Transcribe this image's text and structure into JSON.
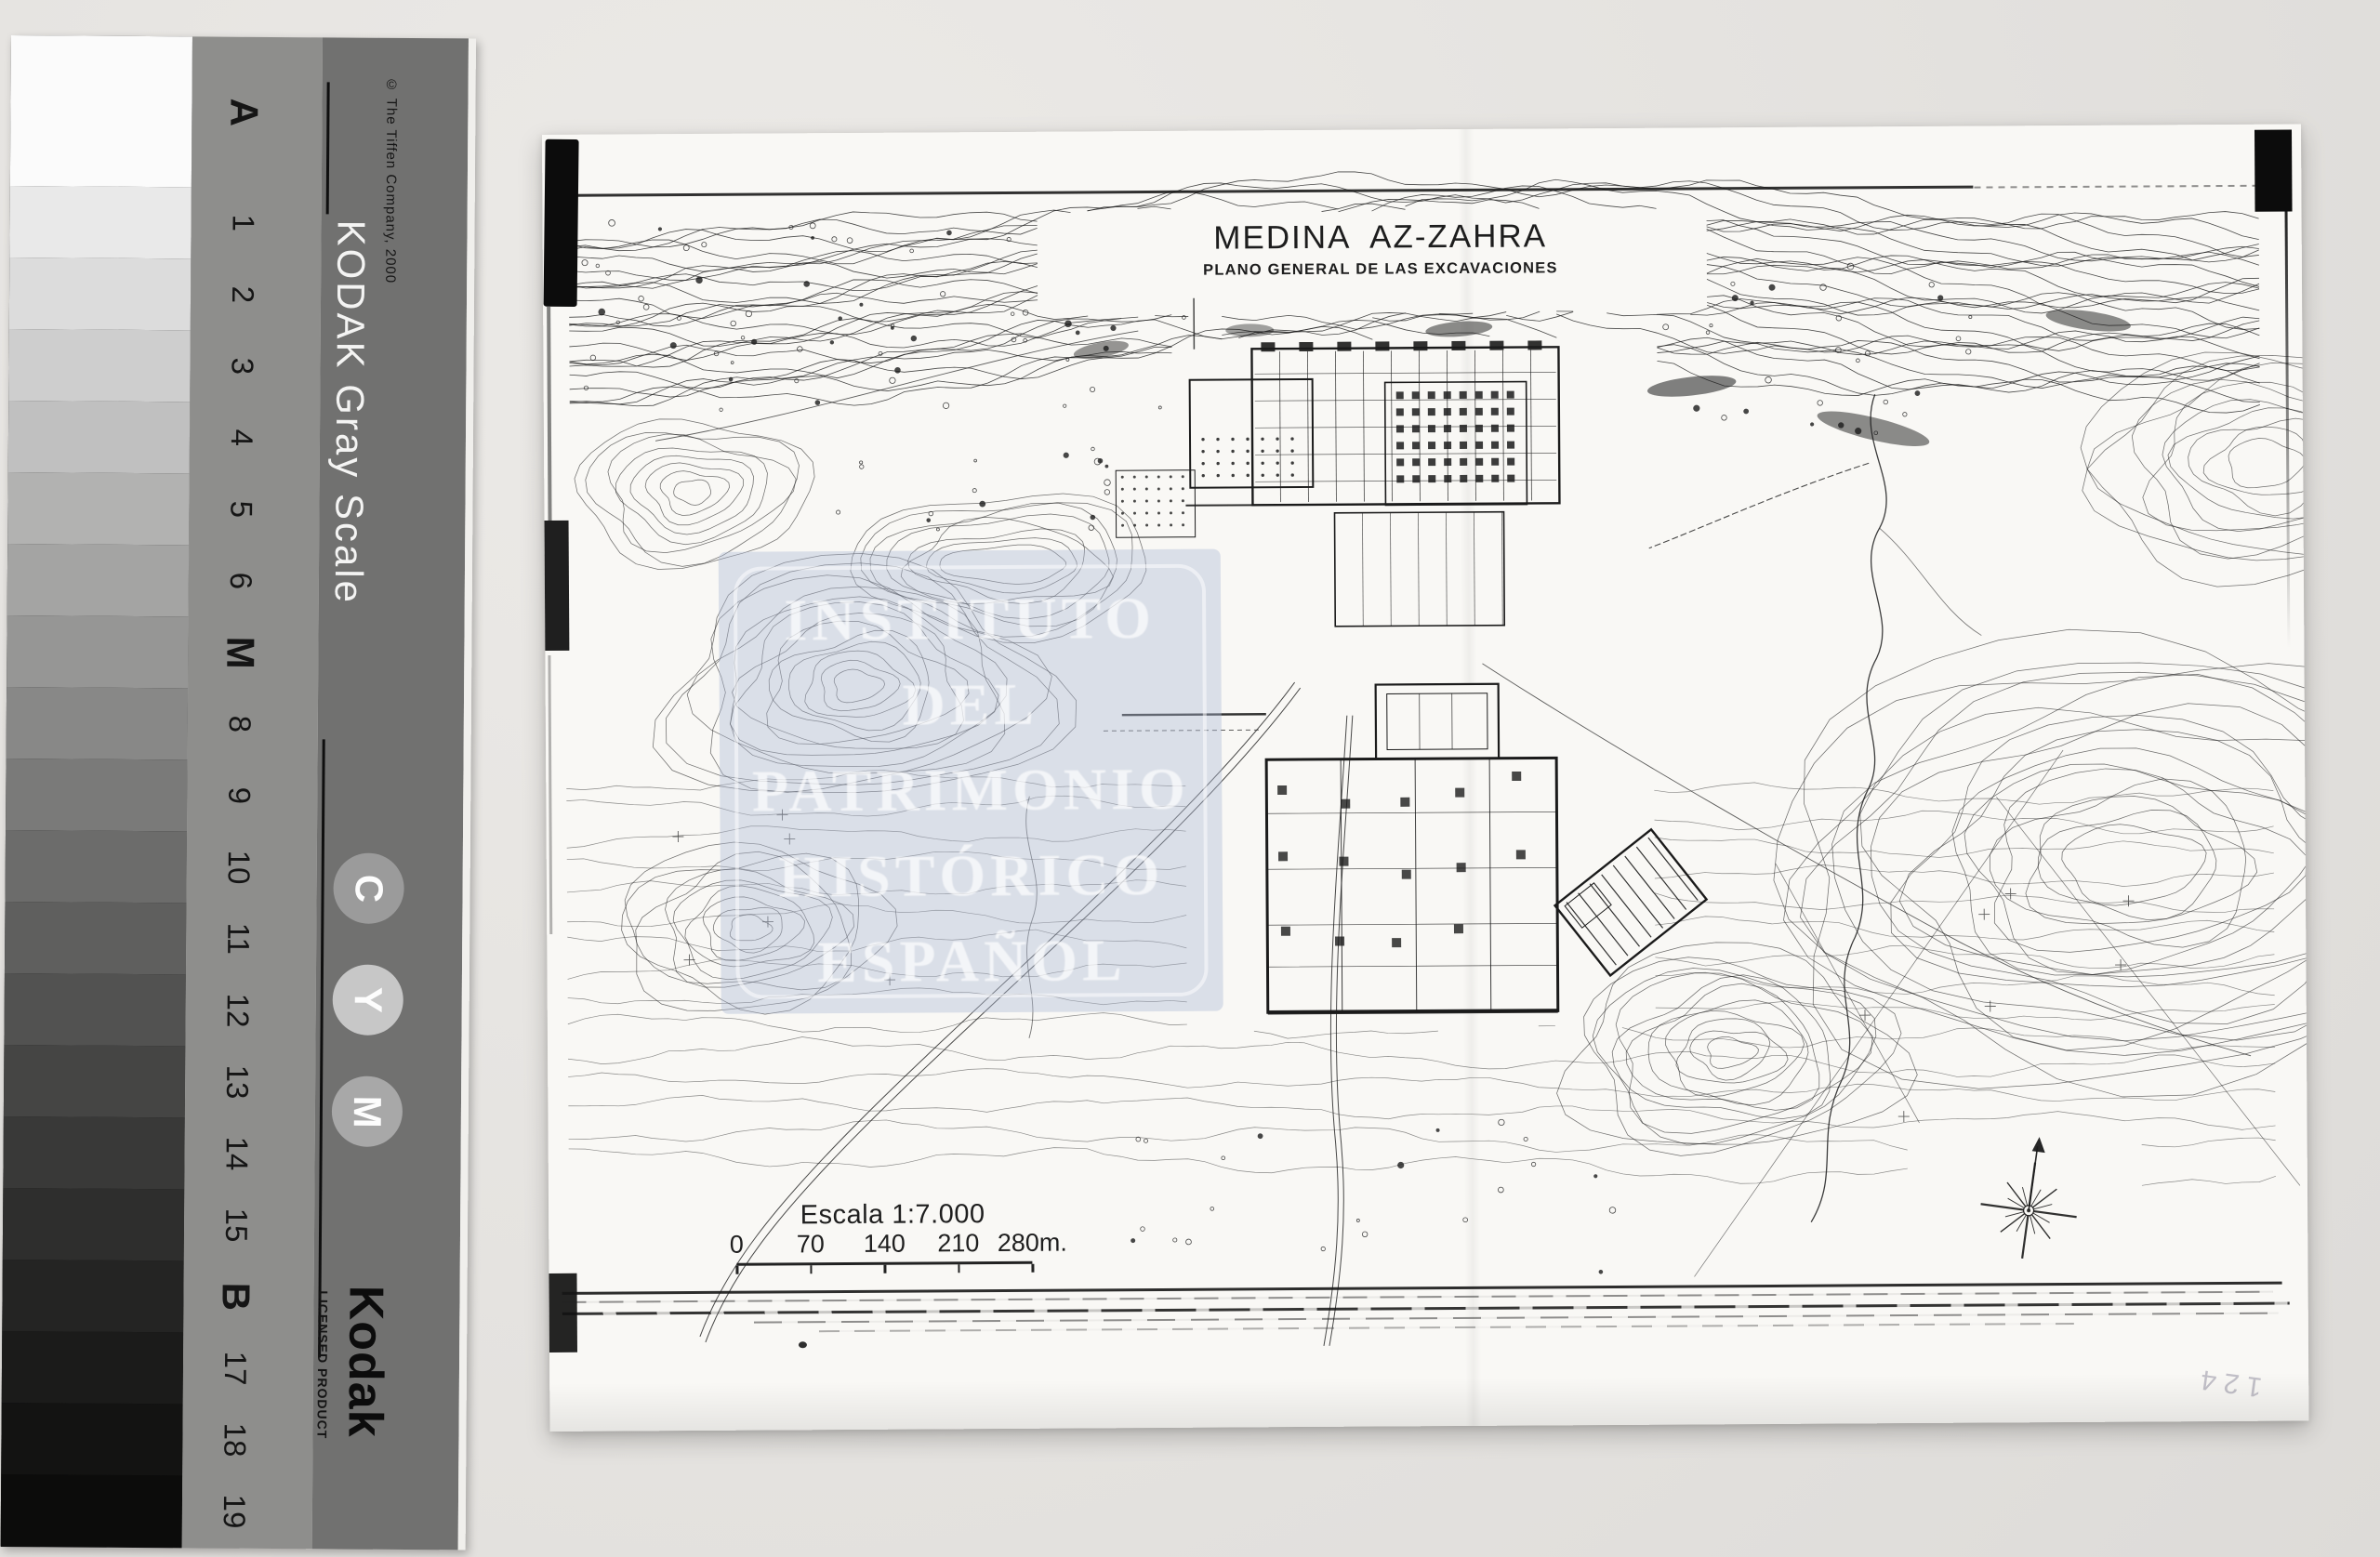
{
  "scene": {
    "background_color": "#e4e2df",
    "description": "Archive photograph of excavation plan with Kodak gray scale strip"
  },
  "gray_scale_card": {
    "brand_line": "KODAK Gray Scale",
    "copyright": "© The Tiffen Company, 2000",
    "steps": [
      "A",
      "1",
      "2",
      "3",
      "4",
      "5",
      "6",
      "M",
      "8",
      "9",
      "10",
      "11",
      "12",
      "13",
      "14",
      "15",
      "B",
      "17",
      "18",
      "19"
    ],
    "patch_grays": [
      "#fbfbfb",
      "#e9e9e9",
      "#dcdcdc",
      "#cecece",
      "#c0c0c0",
      "#b2b2b1",
      "#a4a4a3",
      "#969695",
      "#888887",
      "#7a7a79",
      "#6c6c6b",
      "#5f5f5e",
      "#525251",
      "#454544",
      "#393938",
      "#2e2e2d",
      "#242423",
      "#1b1b1a",
      "#131312",
      "#0c0c0b"
    ],
    "band_color": "#8e8e8c",
    "panel_color": "#717170",
    "ink_circles": [
      {
        "label": "C",
        "color": "#9b9b9b"
      },
      {
        "label": "Y",
        "color": "#c7c7c7"
      },
      {
        "label": "M",
        "color": "#a8a8a8"
      }
    ],
    "logo": "Kodak",
    "licensed_text": "LICENSED PRODUCT"
  },
  "map_sheet": {
    "title": "MEDINA  AZ-ZAHRA",
    "subtitle": "PLANO GENERAL DE LAS EXCAVACIONES",
    "scale_heading": "Escala 1:7.000",
    "scale_tick_labels": [
      "0",
      "70",
      "140",
      "210",
      "280m."
    ],
    "scale_tick_positions": [
      0,
      25,
      50,
      75,
      100
    ],
    "pencil_note": "124",
    "ink_color": "#1b1b1b",
    "paper_color": "#f9f8f5"
  },
  "watermark": {
    "lines": [
      "INSTITUTO",
      "DEL",
      "PATRIMONIO",
      "HISTÓRICO",
      "ESPAÑOL"
    ],
    "band_color": "rgba(173,184,212,0.40)",
    "text_color": "rgba(255,255,255,0.68)"
  }
}
